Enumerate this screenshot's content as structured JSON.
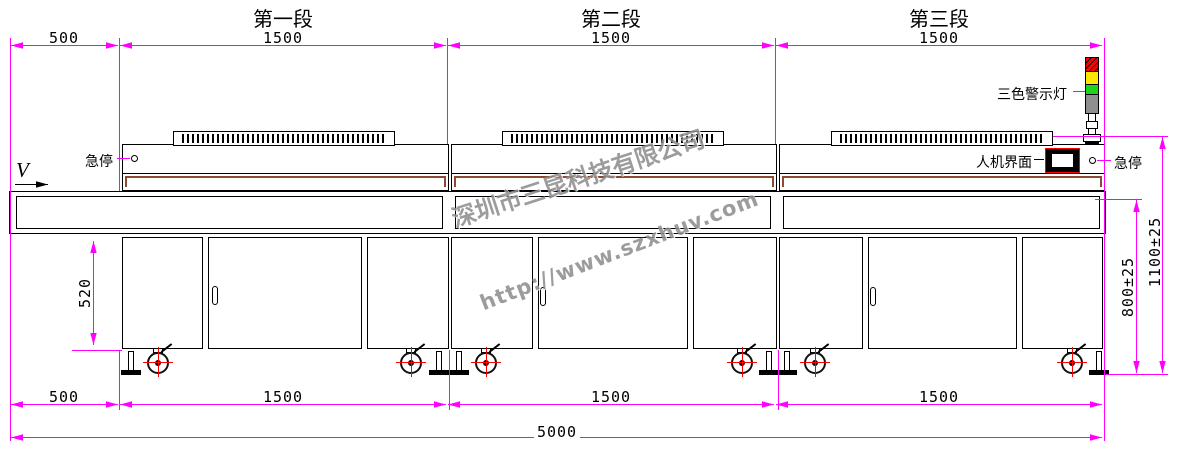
{
  "title_row": {
    "sections": [
      "第一段",
      "第二段",
      "第三段"
    ]
  },
  "dimensions": {
    "top": [
      "500",
      "1500",
      "1500",
      "1500"
    ],
    "bottom": [
      "500",
      "1500",
      "1500",
      "1500"
    ],
    "overall_length": "5000",
    "cabinet_height": "520",
    "conveyor_height": "800±25",
    "total_height": "1100±25"
  },
  "labels": {
    "estop_left": "急停",
    "estop_right": "急停",
    "hmi": "人机界面",
    "warning_light": "三色警示灯",
    "direction": "V"
  },
  "watermark": {
    "company": "深圳市三昆科技有限公司",
    "url": "http://www.szxhuv.com"
  },
  "colors": {
    "dimension_line": "#ff00ff",
    "outline": "#000000",
    "belt_trim": "#8c4a32",
    "alarm_red": "#ff0000",
    "alarm_yellow": "#ffe600",
    "alarm_green": "#1ed31e",
    "alarm_gray": "#8f8f8f",
    "accent_red": "#ff0000",
    "watermark_gray": "#8f8f8f"
  }
}
